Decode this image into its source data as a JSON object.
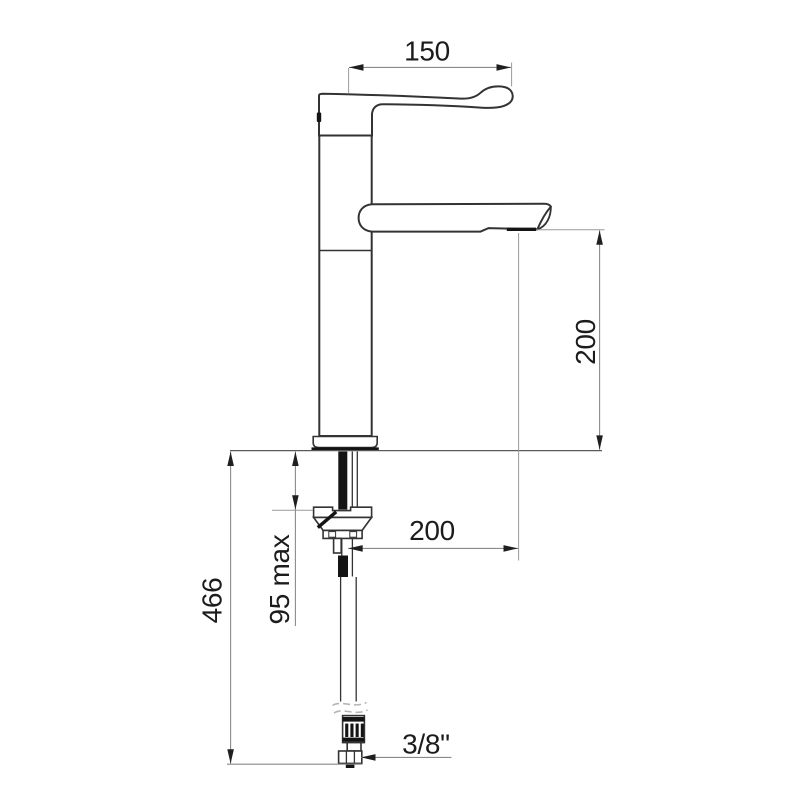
{
  "drawing": {
    "dimension_labels": {
      "handle_length": "150",
      "spout_height": "200",
      "spout_reach": "200",
      "max_deck_thickness": "95 max",
      "below_deck_height": "466",
      "hose_connection": "3/8\""
    },
    "colors": {
      "background": "#ffffff",
      "outline": "#333333",
      "solid_fill": "#141414",
      "dim_line": "#8a8a8a",
      "ext_line": "#9a9a9a",
      "deck_line": "#5a5a5a",
      "arrow": "#1f1f1f",
      "text_color": "#1c1c1c",
      "break_line": "#b5b5b5"
    }
  }
}
